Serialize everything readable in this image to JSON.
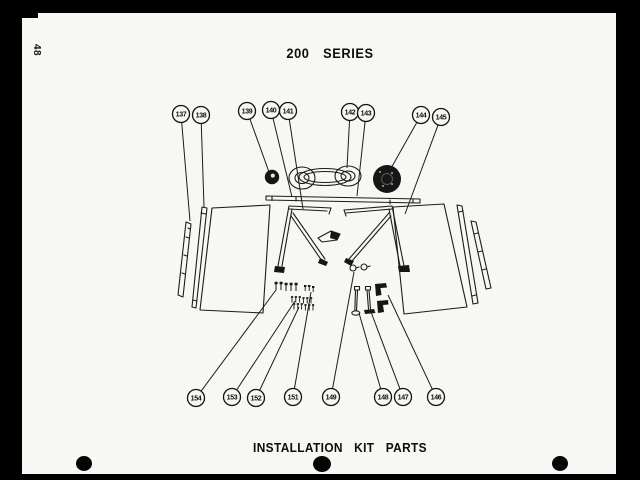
{
  "page": {
    "number": "48",
    "header_title": "200 SERIES",
    "footer_title": "INSTALLATION KIT PARTS"
  },
  "colors": {
    "scan_border": "#000000",
    "paper": "#f7f7f4",
    "ink": "#1c1c1c"
  },
  "diagram": {
    "callouts": [
      {
        "id": "137",
        "cx": 181,
        "cy": 114,
        "tx": 190,
        "ty": 221
      },
      {
        "id": "138",
        "cx": 201,
        "cy": 115,
        "tx": 204,
        "ty": 207
      },
      {
        "id": "139",
        "cx": 247,
        "cy": 111,
        "tx": 269,
        "ty": 172
      },
      {
        "id": "140",
        "cx": 271,
        "cy": 110,
        "tx": 292,
        "ty": 197
      },
      {
        "id": "141",
        "cx": 288,
        "cy": 111,
        "tx": 303,
        "ty": 209
      },
      {
        "id": "142",
        "cx": 350,
        "cy": 112,
        "tx": 347,
        "ty": 168
      },
      {
        "id": "143",
        "cx": 366,
        "cy": 113,
        "tx": 357,
        "ty": 196
      },
      {
        "id": "144",
        "cx": 421,
        "cy": 115,
        "tx": 390,
        "ty": 170
      },
      {
        "id": "145",
        "cx": 441,
        "cy": 117,
        "tx": 405,
        "ty": 214
      },
      {
        "id": "146",
        "cx": 436,
        "cy": 397,
        "tx": 388,
        "ty": 295
      },
      {
        "id": "147",
        "cx": 403,
        "cy": 397,
        "tx": 371,
        "ty": 312
      },
      {
        "id": "148",
        "cx": 383,
        "cy": 397,
        "tx": 359,
        "ty": 313
      },
      {
        "id": "149",
        "cx": 331,
        "cy": 397,
        "tx": 354,
        "ty": 272
      },
      {
        "id": "151",
        "cx": 293,
        "cy": 397,
        "tx": 311,
        "ty": 292
      },
      {
        "id": "152",
        "cx": 256,
        "cy": 398,
        "tx": 299,
        "ty": 307
      },
      {
        "id": "153",
        "cx": 232,
        "cy": 397,
        "tx": 295,
        "ty": 301
      },
      {
        "id": "154",
        "cx": 196,
        "cy": 398,
        "tx": 276,
        "ty": 290
      }
    ]
  }
}
